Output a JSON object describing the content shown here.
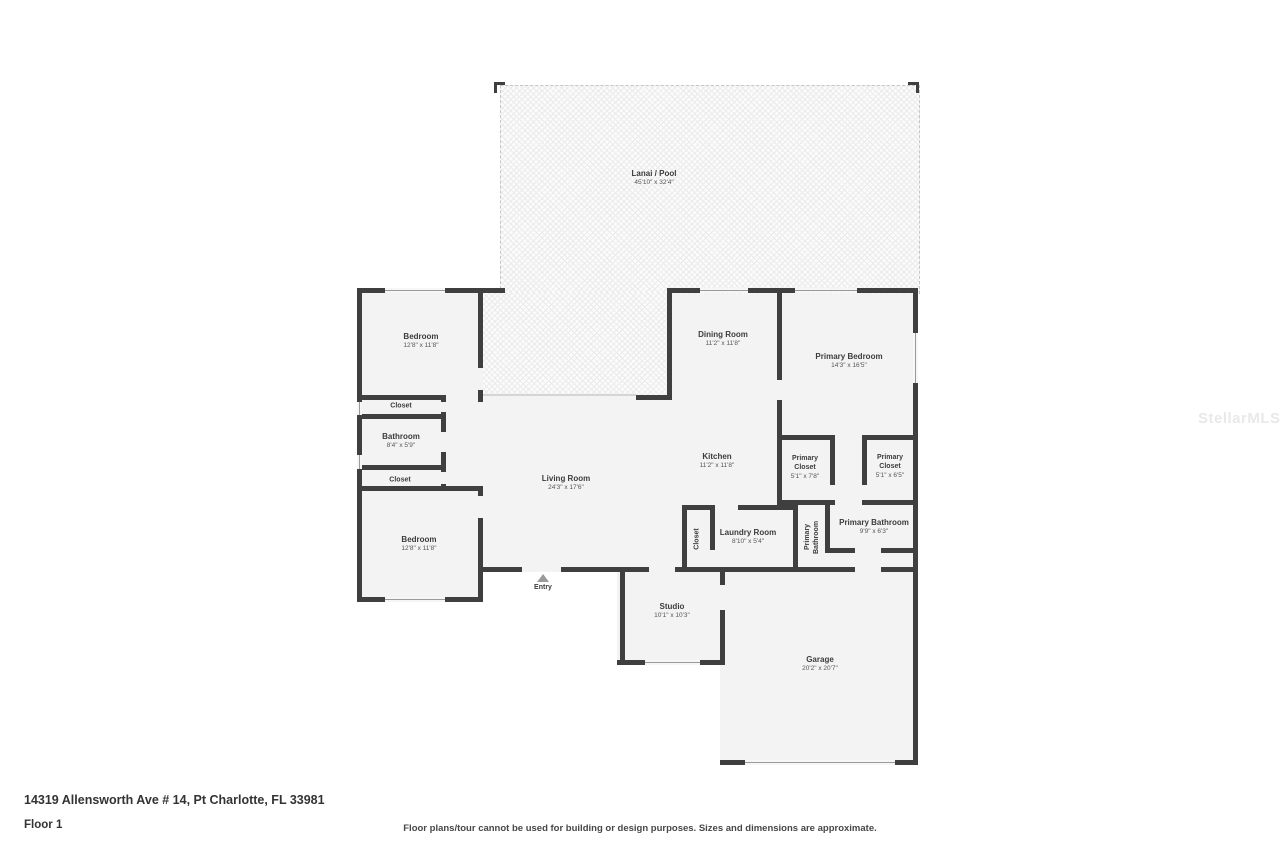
{
  "page": {
    "address": "14319 Allensworth Ave # 14, Pt Charlotte, FL 33981",
    "floor_label": "Floor 1",
    "disclaimer": "Floor plans/tour cannot be used for building or design purposes. Sizes and dimensions are approximate.",
    "watermark": "StellarMLS"
  },
  "entry": {
    "label": "Entry"
  },
  "rooms": [
    {
      "name": "Lanai / Pool",
      "dims": "45'10\" x 32'4\""
    },
    {
      "name": "Bedroom",
      "dims": "12'8\" x 11'8\""
    },
    {
      "name": "Closet",
      "dims": ""
    },
    {
      "name": "Bathroom",
      "dims": "8'4\" x 5'9\""
    },
    {
      "name": "Closet",
      "dims": ""
    },
    {
      "name": "Bedroom",
      "dims": "12'8\" x 11'8\""
    },
    {
      "name": "Living Room",
      "dims": "24'3\" x 17'6\""
    },
    {
      "name": "Dining Room",
      "dims": "11'2\" x 11'8\""
    },
    {
      "name": "Primary Bedroom",
      "dims": "14'3\" x 16'5\""
    },
    {
      "name": "Kitchen",
      "dims": "11'2\" x 11'8\""
    },
    {
      "name": "Primary Closet",
      "dims": "5'1\" x 7'8\""
    },
    {
      "name": "Primary Closet",
      "dims": "5'1\" x 6'5\""
    },
    {
      "name": "Closet",
      "dims": ""
    },
    {
      "name": "Laundry Room",
      "dims": "8'10\" x 5'4\""
    },
    {
      "name": "Primary Bathroom",
      "dims": ""
    },
    {
      "name": "Primary Bathroom",
      "dims": "9'9\" x 6'3\""
    },
    {
      "name": "Studio",
      "dims": "10'1\" x 10'3\""
    },
    {
      "name": "Garage",
      "dims": "20'2\" x 20'7\""
    }
  ]
}
